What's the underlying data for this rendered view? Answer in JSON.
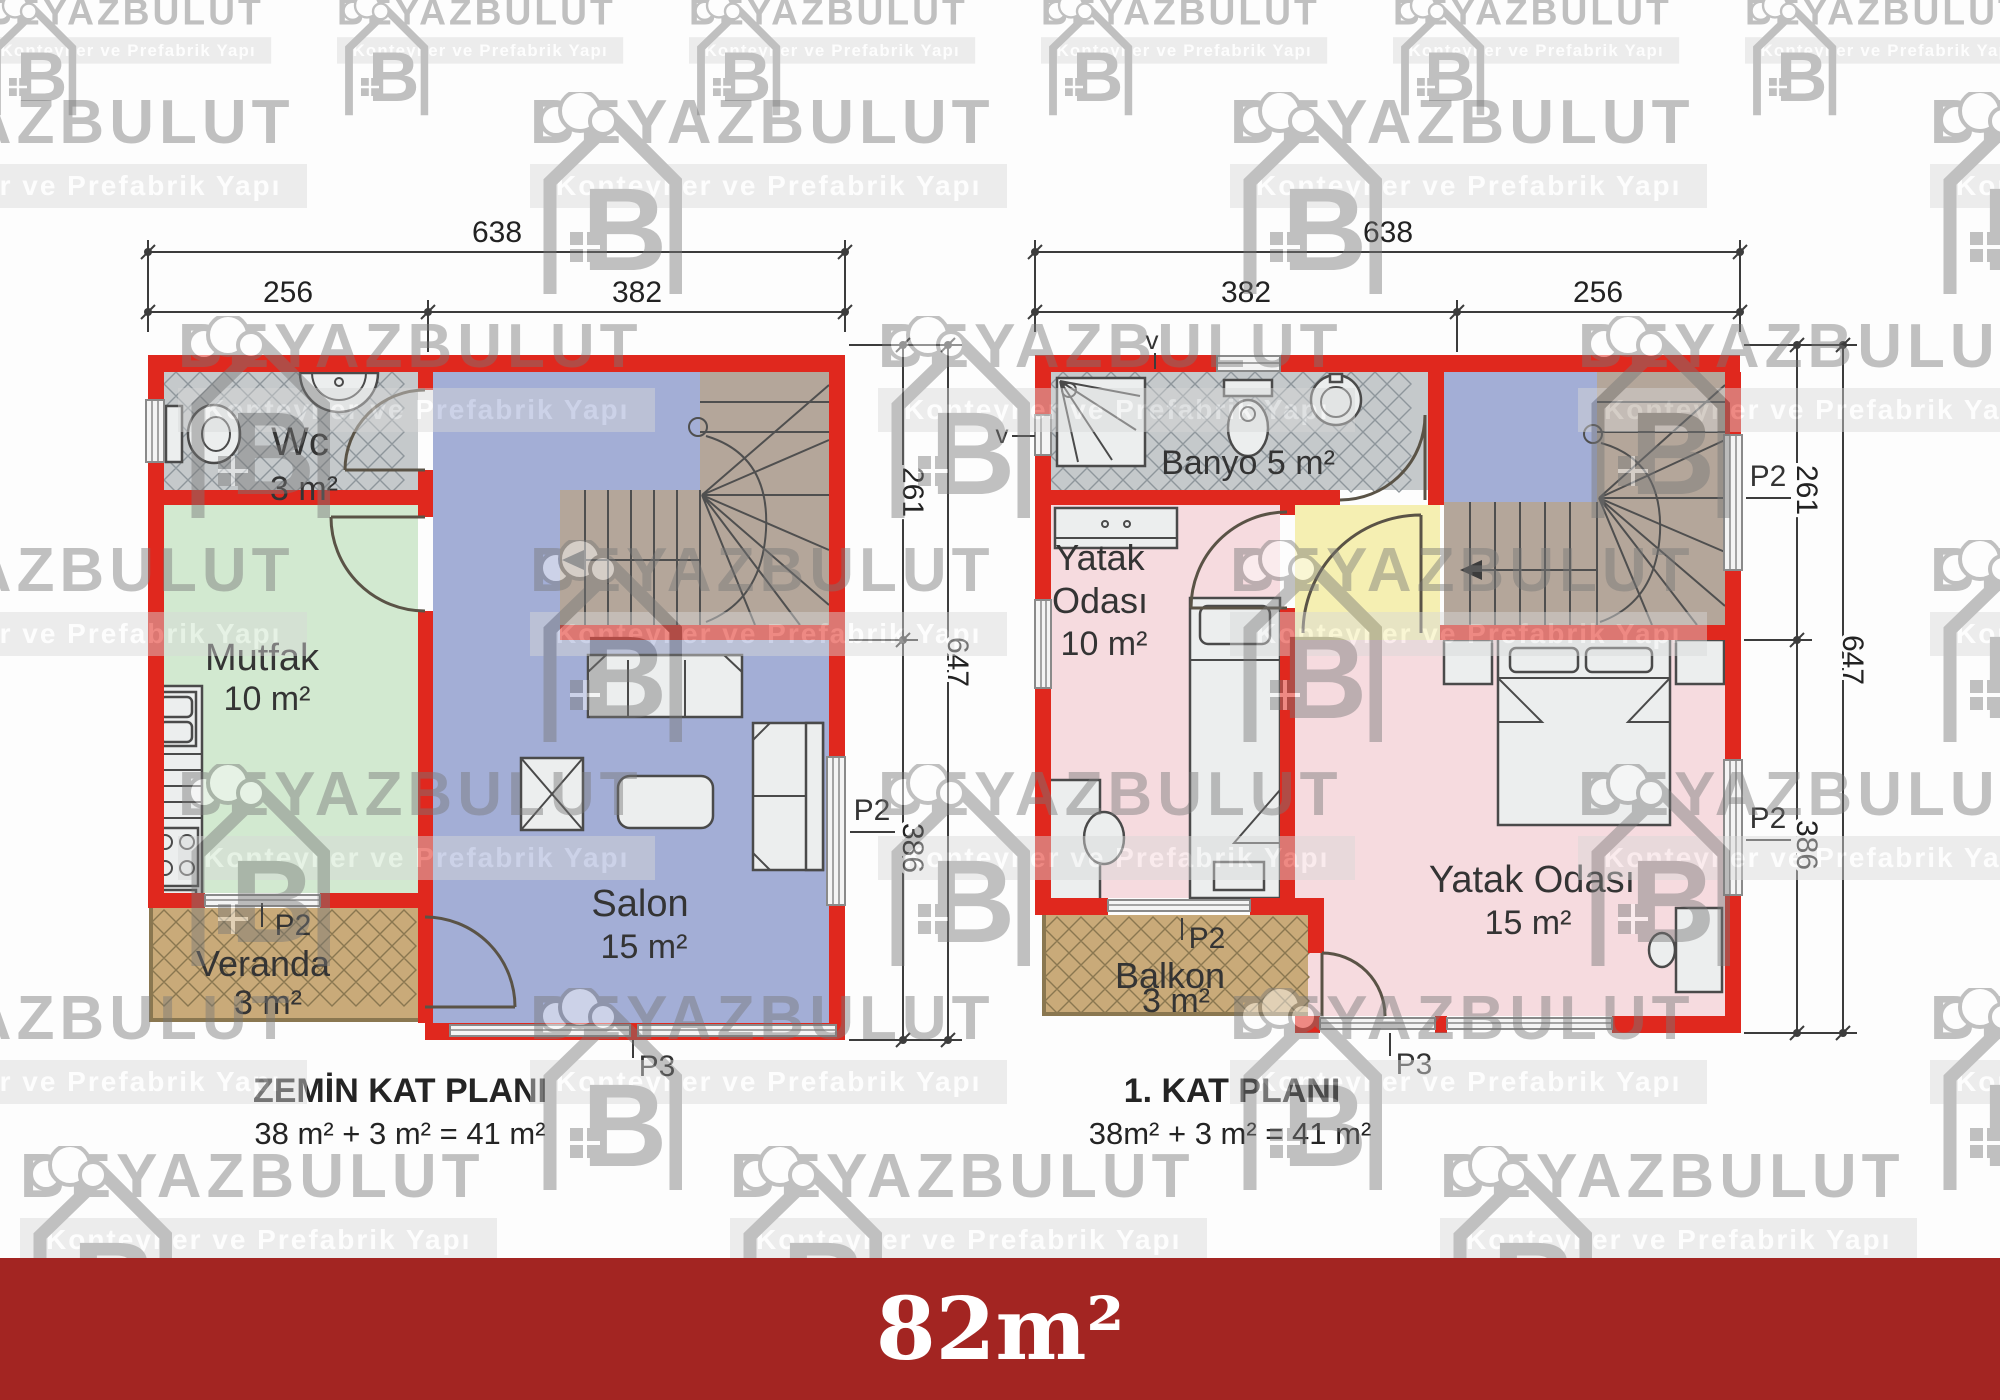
{
  "watermark": {
    "brand": "BEYAZBULUT",
    "tagline": "Konteyner ve Prefabrik Yapı"
  },
  "banner": {
    "label": "82m²"
  },
  "colors": {
    "wall": "#e0281e",
    "wc_floor": "#c5c9cb",
    "hatch_line": "#8e969b",
    "kitchen": "#d2e9d0",
    "living": "#a3aed6",
    "bedroom": "#f6dbdf",
    "hall": "#f5efb2",
    "stairs": "#b4a69a",
    "porch": "#c9aa79",
    "porch_line": "#8a7750",
    "label": "#343434",
    "banner": "#a32522",
    "wm": "#787878",
    "wmband": "#d8d8d8"
  },
  "ground_plan": {
    "title": "ZEMİN KAT PLANI",
    "area_equation": "38 m² + 3 m² = 41 m²",
    "dims": {
      "width_total": "638",
      "width_a": "256",
      "width_b": "382",
      "height_a": "261",
      "height_b": "386",
      "height_total": "647"
    },
    "labels": {
      "window": "P2",
      "door": "P3"
    },
    "rooms": {
      "wc": {
        "name": "Wc",
        "area": "3 m²"
      },
      "kitchen": {
        "name": "Mutfak",
        "area": "10 m²"
      },
      "living": {
        "name": "Salon",
        "area": "15 m²"
      },
      "veranda": {
        "name": "Veranda",
        "area": "3 m²"
      }
    }
  },
  "first_plan": {
    "title": "1. KAT PLANI",
    "area_equation": "38m² + 3 m² = 41 m²",
    "dims": {
      "width_total": "638",
      "width_a": "382",
      "width_b": "256",
      "height_a": "261",
      "height_b": "386",
      "height_total": "647"
    },
    "labels": {
      "window": "P2",
      "door": "P3",
      "vent": "v"
    },
    "rooms": {
      "bath": {
        "name": "Banyo 5 m²"
      },
      "bedroom_small": {
        "line1": "Yatak",
        "line2": "Odası",
        "line3": "10 m²"
      },
      "bedroom_large": {
        "name": "Yatak Odası",
        "area": "15 m²"
      },
      "balcony": {
        "name": "Balkon",
        "area": "3 m²"
      }
    }
  }
}
